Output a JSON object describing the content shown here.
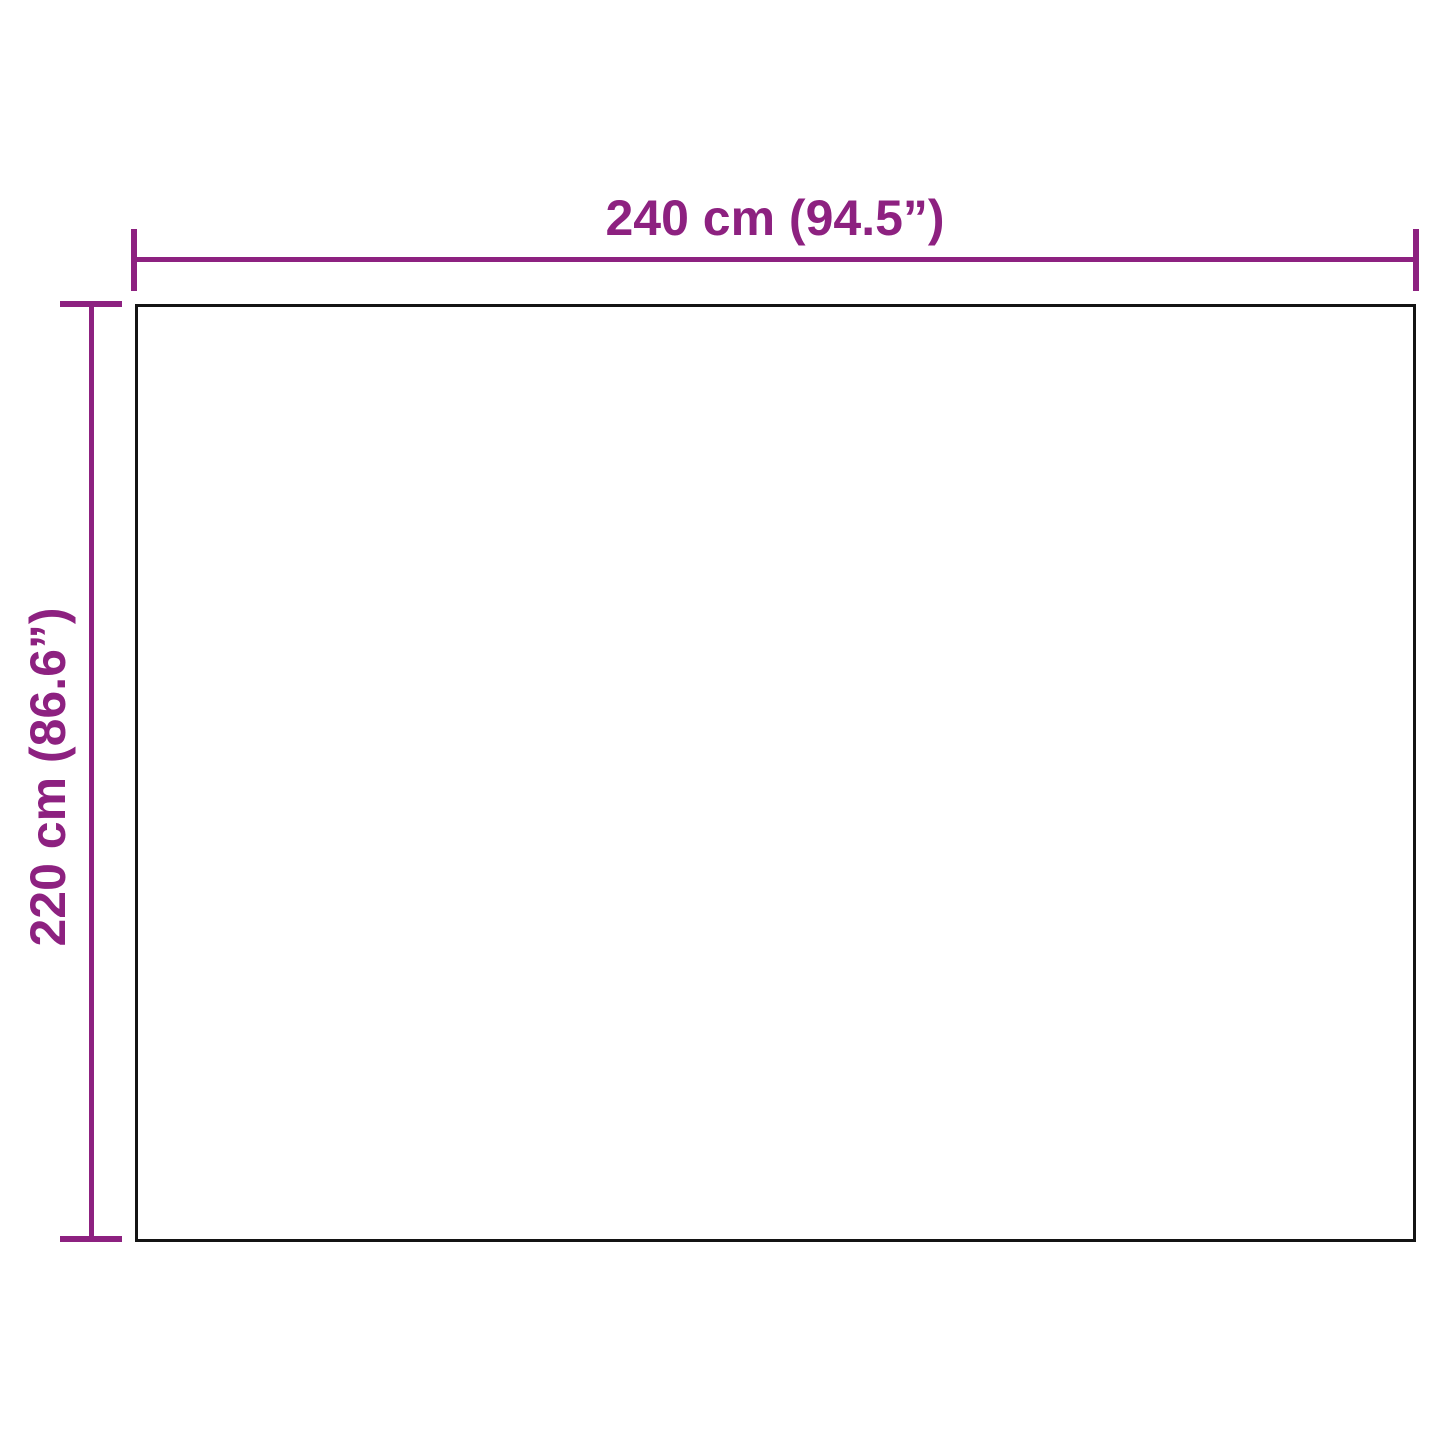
{
  "diagram": {
    "type": "product-dimension-drawing",
    "background_color": "#ffffff",
    "accent_color": "#8d2180",
    "outline_color": "#141414",
    "width": {
      "label": "240 cm (94.5”)",
      "value_cm": 240,
      "value_in": 94.5
    },
    "height": {
      "label": "220 cm (86.6”)",
      "value_cm": 220,
      "value_in": 86.6
    }
  }
}
